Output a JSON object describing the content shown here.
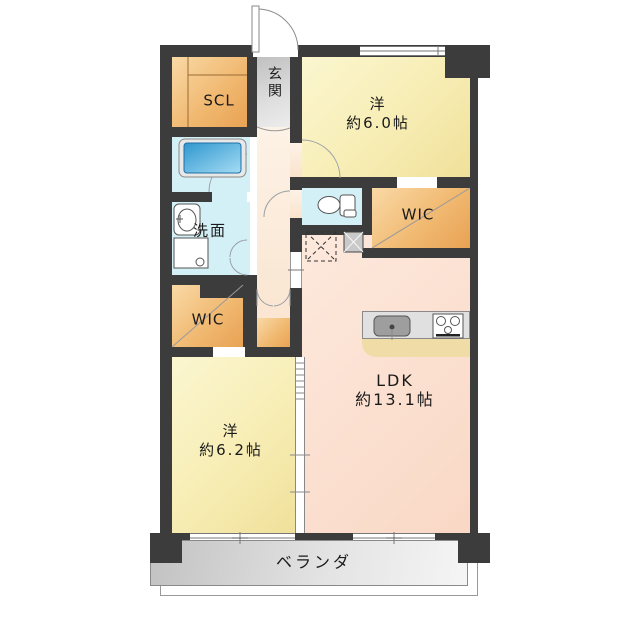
{
  "plan": {
    "title": "apartment-floor-plan",
    "rooms": {
      "scl": {
        "label": "SCL"
      },
      "genkan": {
        "label": "玄関"
      },
      "bedroom_top": {
        "label": "洋",
        "size": "約6.0帖"
      },
      "wic_right": {
        "label": "WIC"
      },
      "washroom": {
        "label": "洗面"
      },
      "wic_left": {
        "label": "WIC"
      },
      "ldk": {
        "label": "LDK",
        "size": "約13.1帖"
      },
      "bedroom_bottom": {
        "label": "洋",
        "size": "約6.2帖"
      },
      "veranda": {
        "label": "ベランダ"
      }
    },
    "icons": [
      "bathtub-icon",
      "toilet-icon",
      "sink-icon",
      "washer-pan-icon",
      "kitchen-sink-icon",
      "stove-icon",
      "refrigerator-space-icon",
      "pipe-shaft-icon"
    ],
    "colors": {
      "wall": "#3c3c3c",
      "bedroom_yellow": "#f7edb4",
      "ldk_pink": "#fbdfcf",
      "closet_orange": "#f0b76e",
      "wet_area_blue": "#d4f0f7",
      "entry_gray": "#cccccc",
      "veranda_gray": "#d9d9d9",
      "kitchen_counter_gray": "#dddddd",
      "kitchen_floor_tan": "#efdca6",
      "bathtub_blue": "#4faedb"
    }
  }
}
